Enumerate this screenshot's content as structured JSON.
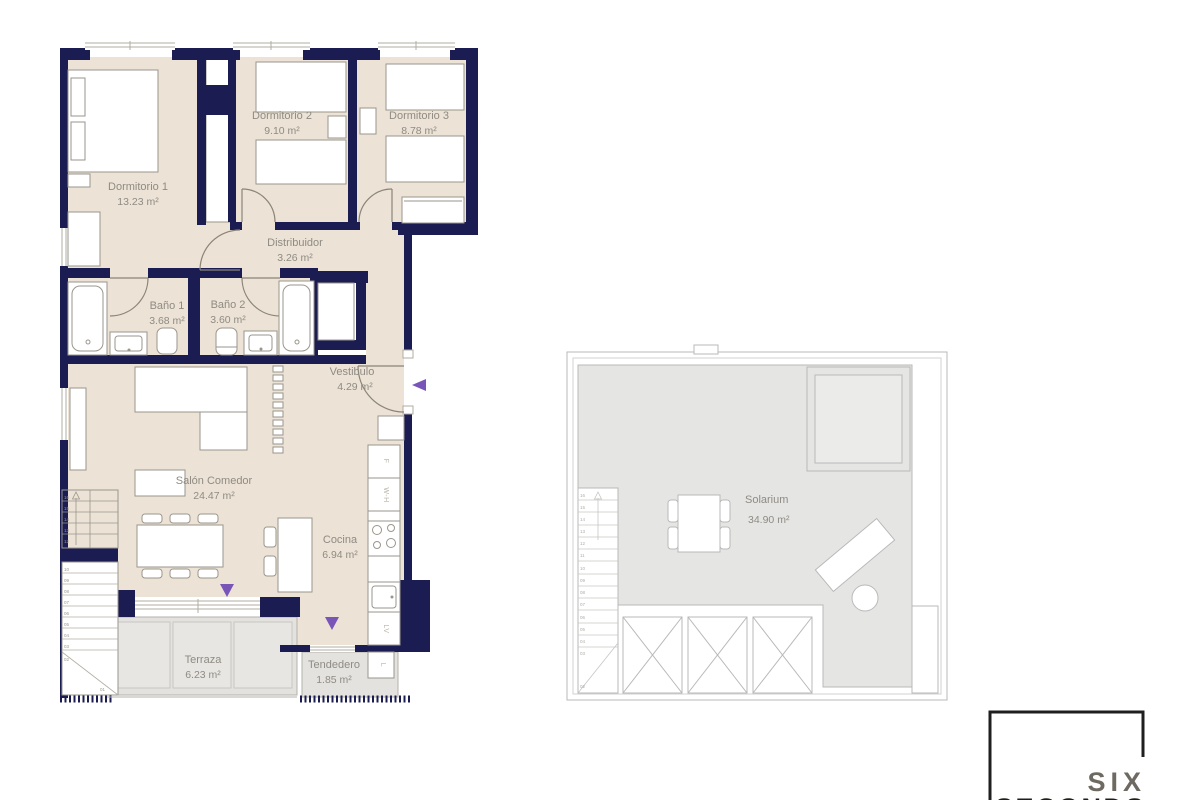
{
  "colors": {
    "wall": "#1b1c52",
    "floor": "#ece2d5",
    "outdoor_gray": "#e3e2df",
    "solarium_gray": "#e5e5e4",
    "furniture_line": "#9a968c",
    "label_gray": "#8f8b83",
    "accent_purple": "#7a55b8",
    "logo_dark": "#211d18",
    "logo_gray": "#6e6a62"
  },
  "rooms": {
    "dorm1": {
      "name": "Dormitorio 1",
      "area": "13.23 m²"
    },
    "dorm2": {
      "name": "Dormitorio 2",
      "area": "9.10 m²"
    },
    "dorm3": {
      "name": "Dormitorio 3",
      "area": "8.78 m²"
    },
    "distribuidor": {
      "name": "Distribuidor",
      "area": "3.26 m²"
    },
    "bano1": {
      "name": "Baño 1",
      "area": "3.68 m²"
    },
    "bano2": {
      "name": "Baño 2",
      "area": "3.60 m²"
    },
    "vestibulo": {
      "name": "Vestibulo",
      "area": "4.29 m²"
    },
    "salon": {
      "name": "Salón Comedor",
      "area": "24.47 m²"
    },
    "cocina": {
      "name": "Cocina",
      "area": "6.94 m²"
    },
    "terraza": {
      "name": "Terraza",
      "area": "6.23 m²"
    },
    "tendedero": {
      "name": "Tendedero",
      "area": "1.85 m²"
    },
    "solarium": {
      "name": "Solarium",
      "area": "34.90 m²"
    }
  },
  "appliances": {
    "fridge": "F",
    "water_heater": "W-H",
    "dishwasher": "LV",
    "washing_machine": "L"
  },
  "stairs": {
    "apartment_upper": [
      "16",
      "15",
      "14",
      "13",
      "12"
    ],
    "apartment_lower": [
      "10",
      "09",
      "08",
      "07",
      "06",
      "05",
      "04",
      "03",
      "02",
      "01"
    ],
    "solarium_steps": [
      "16",
      "15",
      "14",
      "13",
      "12",
      "11",
      "10",
      "09",
      "08",
      "07",
      "06",
      "05",
      "04",
      "03",
      "02"
    ]
  },
  "logo": {
    "line1": "SIX",
    "line2": "SECONDS"
  }
}
